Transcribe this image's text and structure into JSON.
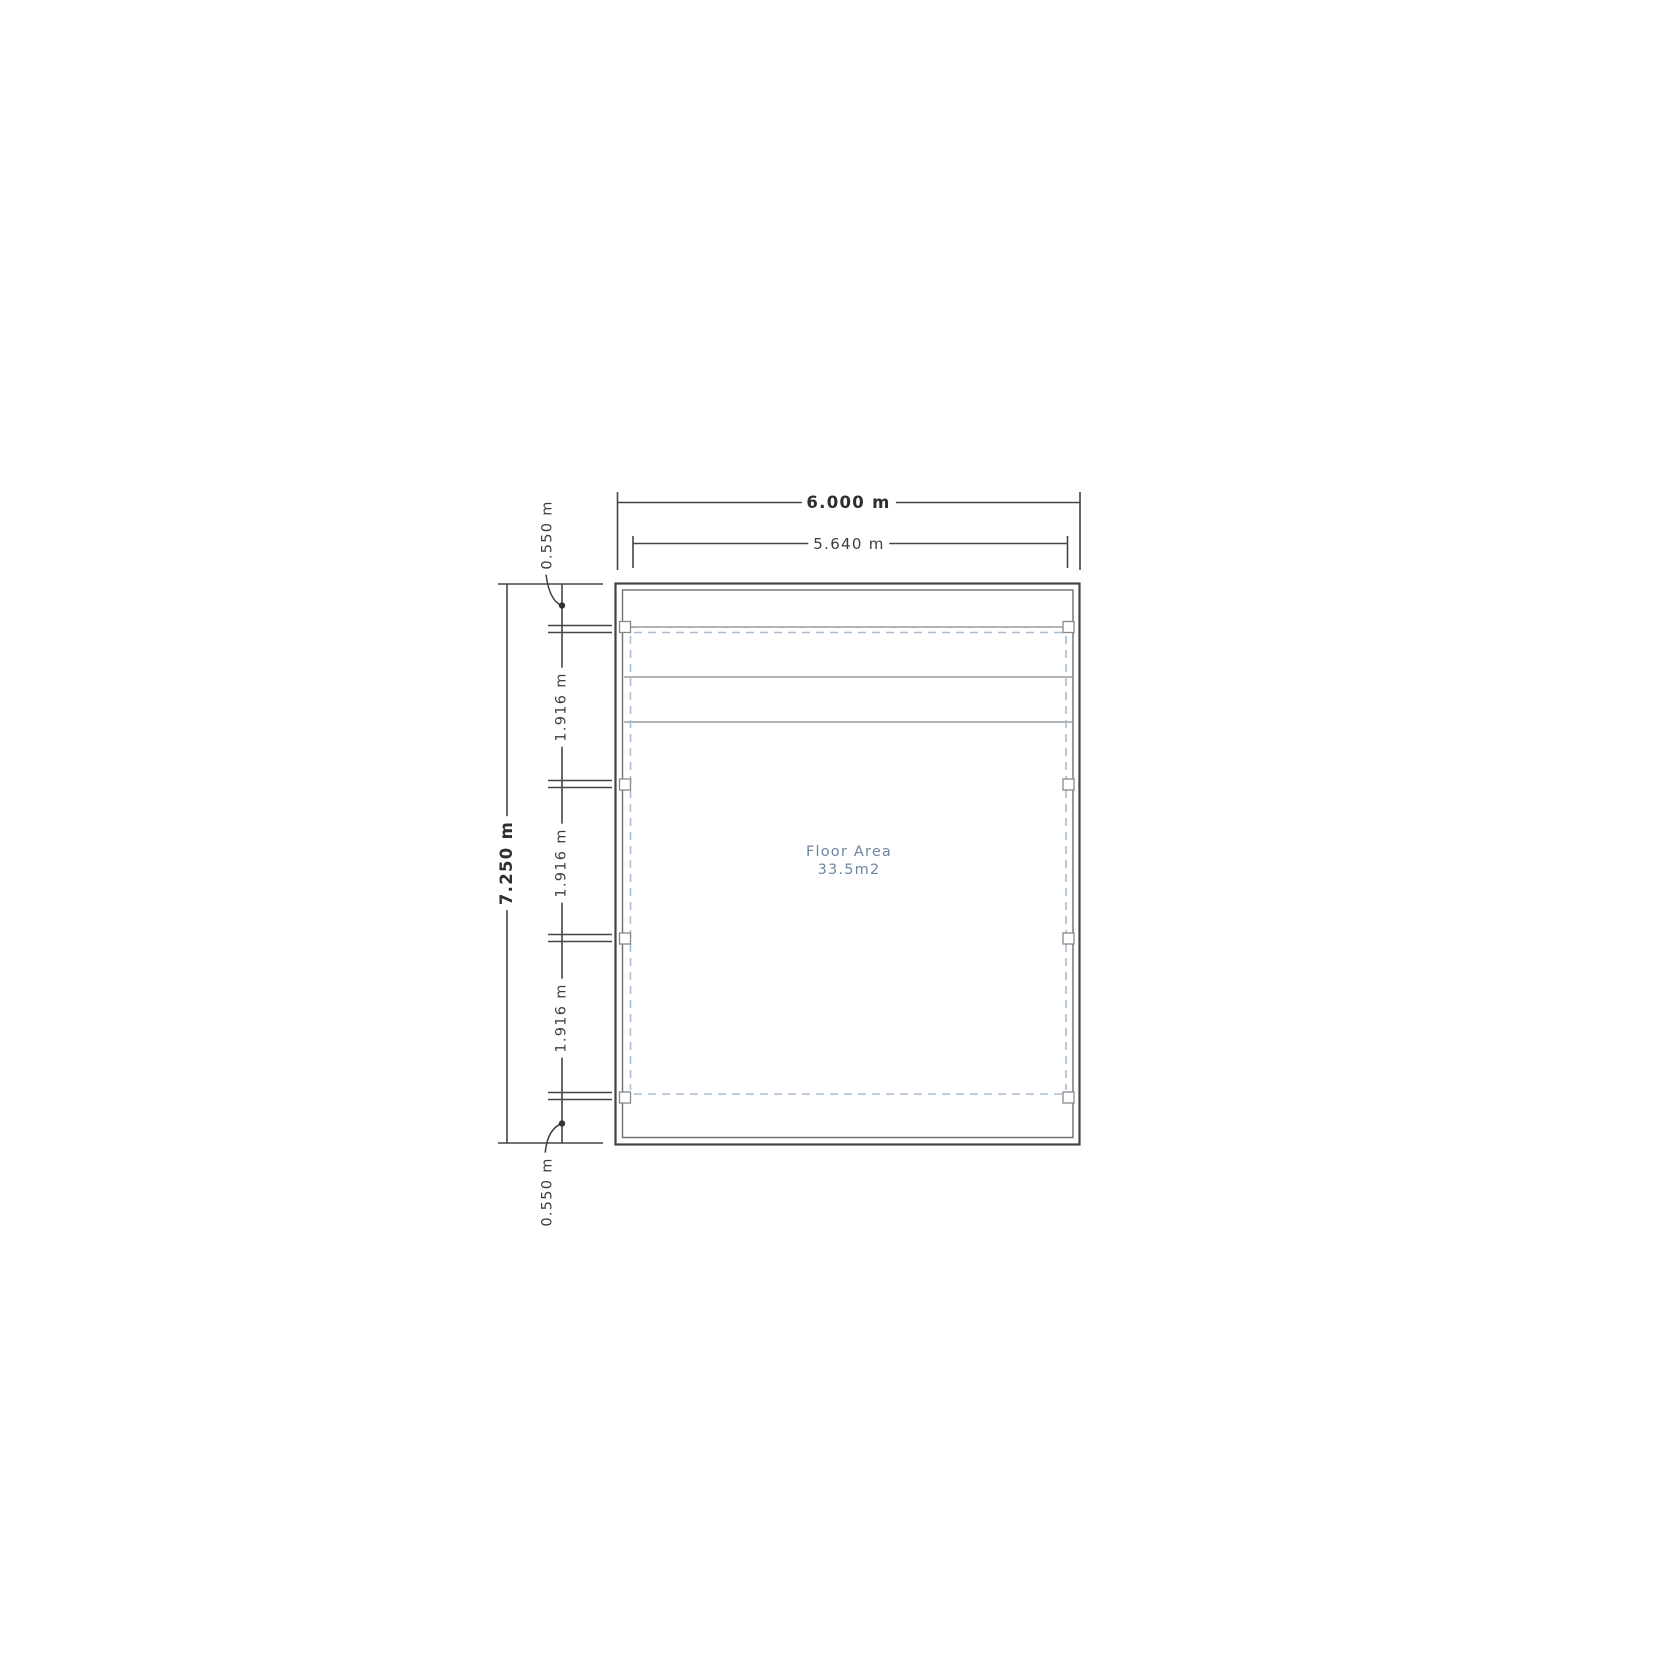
{
  "drawing": {
    "type": "floor-plan",
    "floor_area": {
      "title": "Floor Area",
      "value": "33.5m2"
    },
    "dimensions": {
      "overall_width": {
        "label": "6.000 m"
      },
      "inner_width": {
        "label": "5.640 m"
      },
      "overall_height": {
        "label": "7.250 m"
      },
      "top_offset": {
        "label": "0.550 m"
      },
      "bay_1": {
        "label": "1.916 m"
      },
      "bay_2": {
        "label": "1.916 m"
      },
      "bay_3": {
        "label": "1.916 m"
      },
      "bottom_offset": {
        "label": "0.550 m"
      }
    },
    "colors": {
      "background": "#ffffff",
      "wall_line": "#444444",
      "inner_wall_line": "#6e6e6e",
      "dimension_line": "#454545",
      "interior_line": "#9b9b9b",
      "dashed_outline": "#a9bed2",
      "dimension_text": "#3d3d3d",
      "floor_area_text": "#6f86a0"
    }
  }
}
